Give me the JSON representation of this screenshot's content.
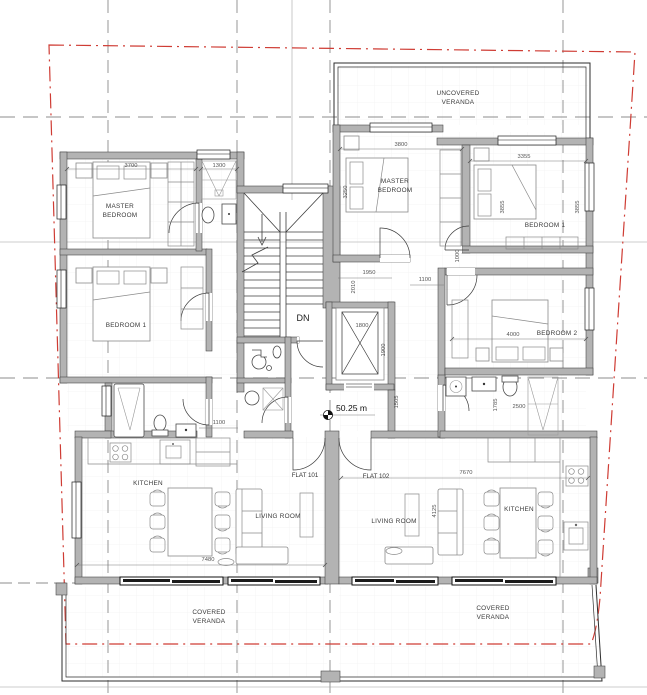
{
  "drawing": {
    "type": "residential floor plan",
    "flats": {
      "flat_101": "FLAT 101",
      "flat_102": "FLAT 102"
    },
    "level_marker": "50.25 m",
    "stair_direction": "DN"
  },
  "rooms": {
    "uncovered_veranda": [
      "UNCOVERED",
      "VERANDA"
    ],
    "covered_veranda_left": [
      "COVERED",
      "VERANDA"
    ],
    "covered_veranda_right": [
      "COVERED",
      "VERANDA"
    ],
    "master_bedroom_left": [
      "MASTER",
      "BEDROOM"
    ],
    "master_bedroom_right": [
      "MASTER",
      "BEDROOM"
    ],
    "bedroom1_left": "BEDROOM 1",
    "bedroom1_right": "BEDROOM 1",
    "bedroom2_right": "BEDROOM 2",
    "kitchen_left": "KITCHEN",
    "kitchen_right": "KITCHEN",
    "living_room_left": "LIVING ROOM",
    "living_room_right": "LIVING ROOM"
  },
  "dimensions": {
    "d3700": "3700",
    "d1300": "1300",
    "d3800": "3800",
    "d3355": "3355",
    "d3250": "3250",
    "d3855a": "3855",
    "d3855b": "3855",
    "d1000": "1000",
    "d1100_left": "1100",
    "d1100_right": "1100",
    "d1950": "1950",
    "d2010": "2010",
    "d1800": "1800",
    "d1900": "1900",
    "d4000": "4000",
    "d2500": "2500",
    "d1785": "1785",
    "d1505": "1505",
    "d7480": "7480",
    "d7670": "7670",
    "d4125": "4125"
  },
  "colors": {
    "boundary_red": "#cf3c34",
    "grid_grey": "#8c8c8c",
    "wall_fill": "#b3b3b3",
    "wall_edge": "#3e3e3e"
  }
}
